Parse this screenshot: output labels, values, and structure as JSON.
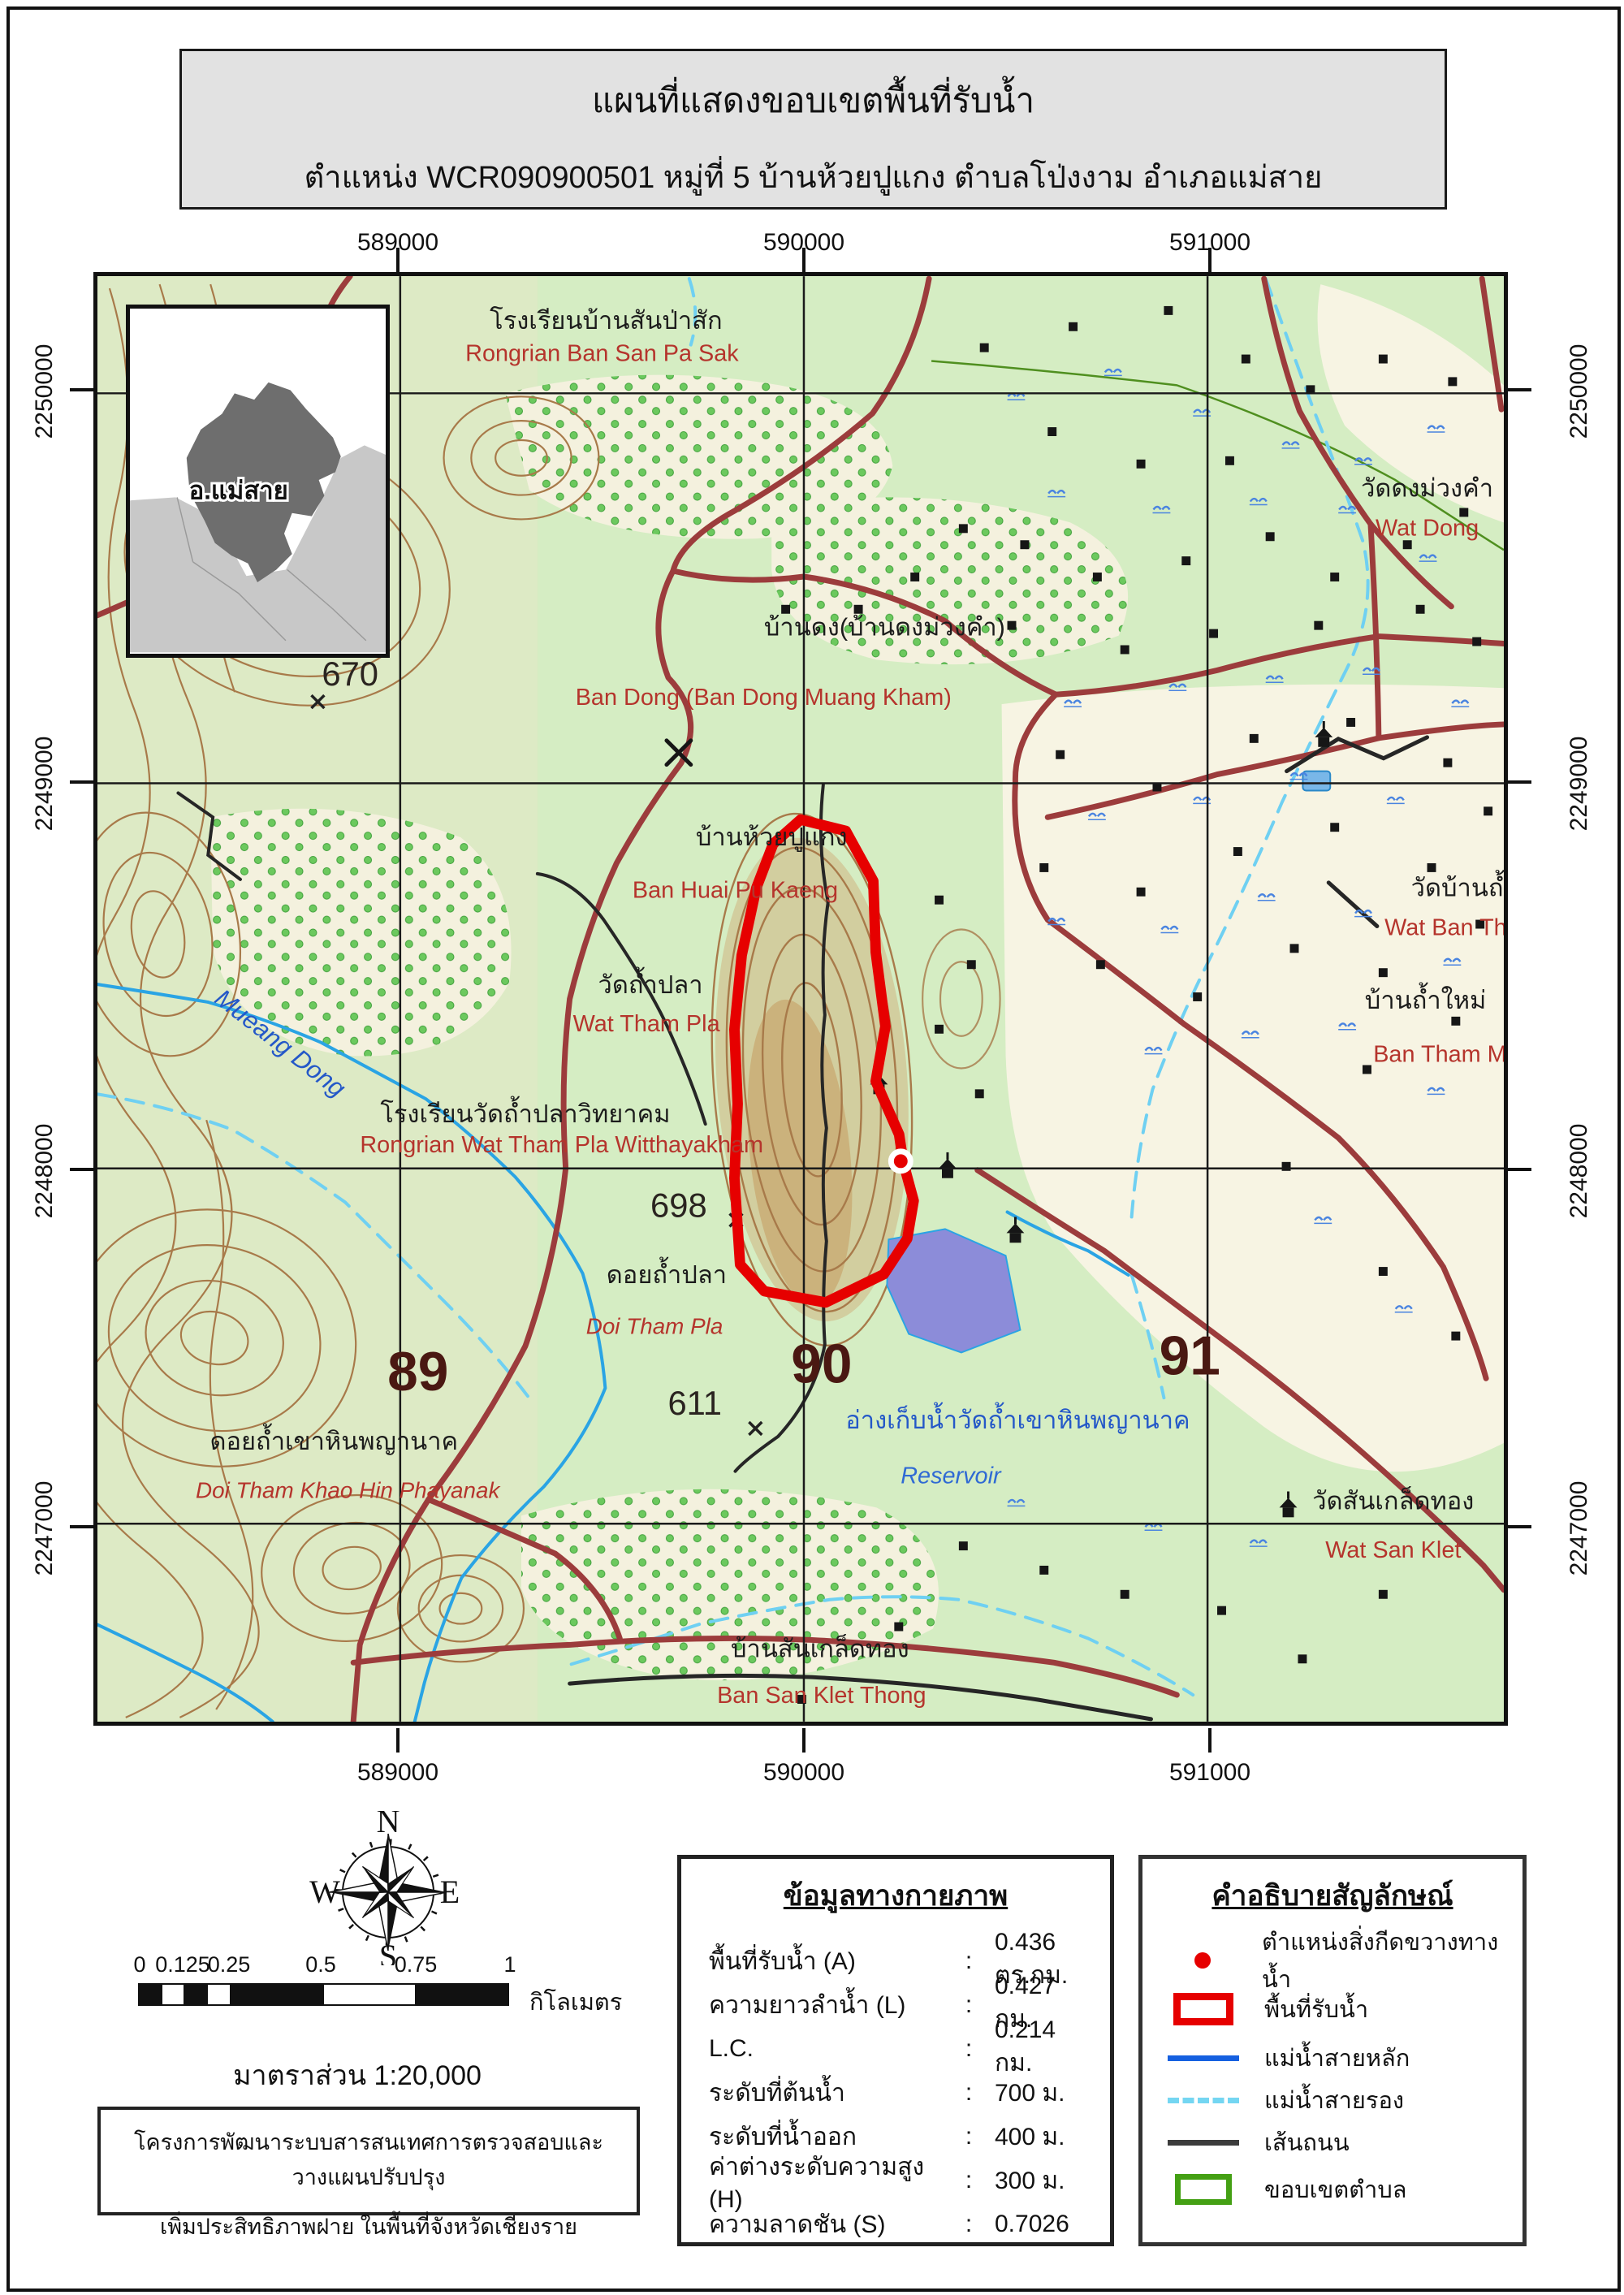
{
  "title": {
    "line1": "แผนที่แสดงขอบเขตพื้นที่รับน้ำ",
    "line2": "ตำแหน่ง WCR090900501 หมู่ที่ 5 บ้านห้วยปูแกง ตำบลโป่งงาม อำเภอแม่สาย"
  },
  "map": {
    "x_labels": [
      "589000",
      "590000",
      "591000"
    ],
    "y_labels": [
      "2250000",
      "2249000",
      "2248000",
      "2247000"
    ],
    "inset_label": "อ.แม่สาย",
    "place_labels": {
      "school1_th": "โรงเรียนบ้านสันป่าสัก",
      "school1_en": "Rongrian Ban San Pa Sak",
      "elev670": "670",
      "bandong_th": "บ้านดง(บ้านดงม่วงคำ)",
      "bandong_en": "Ban Dong (Ban Dong Muang Kham)",
      "huaipukaeng_th": "บ้านห้วยปูแกง",
      "huaipukaeng_en": "Ban Huai Pu Kaeng",
      "watthampla_th": "วัดถ้ำปลา",
      "watthampla_en": "Wat Tham Pla",
      "school2_th": "โรงเรียนวัดถ้ำปลาวิทยาคม",
      "school2_en": "Rongrian Wat Tham Pla Witthayakham",
      "mueangdong": "Mueang Dong",
      "elev698": "698",
      "doithampla_th": "ดอยถ้ำปลา",
      "doithampla_en": "Doi Tham Pla",
      "grid89": "89",
      "grid90": "90",
      "grid91": "91",
      "elev611": "611",
      "doikhaohin_th": "ดอยถ้ำเขาหินพญานาค",
      "doikhaohin_en": "Doi Tham Khao Hin Phayanak",
      "reservoir_th": "อ่างเก็บน้ำวัดถ้ำเขาหินพญานาค",
      "reservoir_en": "Reservoir",
      "watsanklet_th": "วัดสันเกล็ดทอง",
      "watsanklet_en": "Wat San Klet",
      "watdong_th": "วัดดงม่วงคำ",
      "watdong_en": "Wat Dong",
      "watban_th": "วัดบ้านถ้ำ",
      "watban_en": "Wat Ban Th",
      "banthammai_th": "บ้านถ้ำใหม่",
      "banthammai_en": "Ban Tham M",
      "bansanklet_th": "บ้านสันเกล็ดทอง",
      "bansanklet_en": "Ban San Klet Thong"
    },
    "watershed_point_coords": "WCR090900501",
    "colors": {
      "watershed_outline": "#e60000",
      "obstruction_point": "#e60000",
      "main_stream": "#1560e0",
      "secondary_stream": "#74d6f2",
      "road": "#3c3c3c",
      "tambon_boundary": "#44a014",
      "topo_road": "#9c3c3c",
      "reservoir_fill": "#8c8cd9"
    }
  },
  "compass": {
    "n": "N",
    "e": "E",
    "s": "S",
    "w": "W"
  },
  "scalebar": {
    "ticks": [
      "0",
      "0.125",
      "0.25",
      "0.5",
      "0.75",
      "1"
    ],
    "unit": "กิโลเมตร",
    "scale_text": "มาตราส่วน 1:20,000"
  },
  "project": {
    "line1": "โครงการพัฒนาระบบสารสนเทศการตรวจสอบและวางแผนปรับปรุง",
    "line2": "เพิ่มประสิทธิภาพฝาย ในพื้นที่จังหวัดเชียงราย"
  },
  "physical_data": {
    "title": "ข้อมูลทางกายภาพ",
    "colon": ":",
    "rows": [
      {
        "label": "พื้นที่รับน้ำ (A)",
        "value": "0.436 ตร.กม."
      },
      {
        "label": "ความยาวลำน้ำ (L)",
        "value": "0.427 กม."
      },
      {
        "label": "L.C.",
        "value": "0.214 กม."
      },
      {
        "label": "ระดับที่ต้นน้ำ",
        "value": "700 ม."
      },
      {
        "label": "ระดับที่น้ำออก",
        "value": "400 ม."
      },
      {
        "label": "ค่าต่างระดับความสูง (H)",
        "value": "300 ม."
      },
      {
        "label": "ความลาดชัน (S)",
        "value": "0.7026"
      }
    ]
  },
  "legend": {
    "title": "คำอธิบายสัญลักษณ์",
    "items": [
      {
        "symbol": "obstruction-point",
        "label": "ตำแหน่งสิ่งกีดขวางทางน้ำ"
      },
      {
        "symbol": "watershed-area",
        "label": "พื้นที่รับน้ำ"
      },
      {
        "symbol": "main-river",
        "label": "แม่น้ำสายหลัก"
      },
      {
        "symbol": "secondary-river",
        "label": "แม่น้ำสายรอง"
      },
      {
        "symbol": "road-line",
        "label": "เส้นถนน"
      },
      {
        "symbol": "tambon-boundary",
        "label": "ขอบเขตตำบล"
      }
    ]
  }
}
